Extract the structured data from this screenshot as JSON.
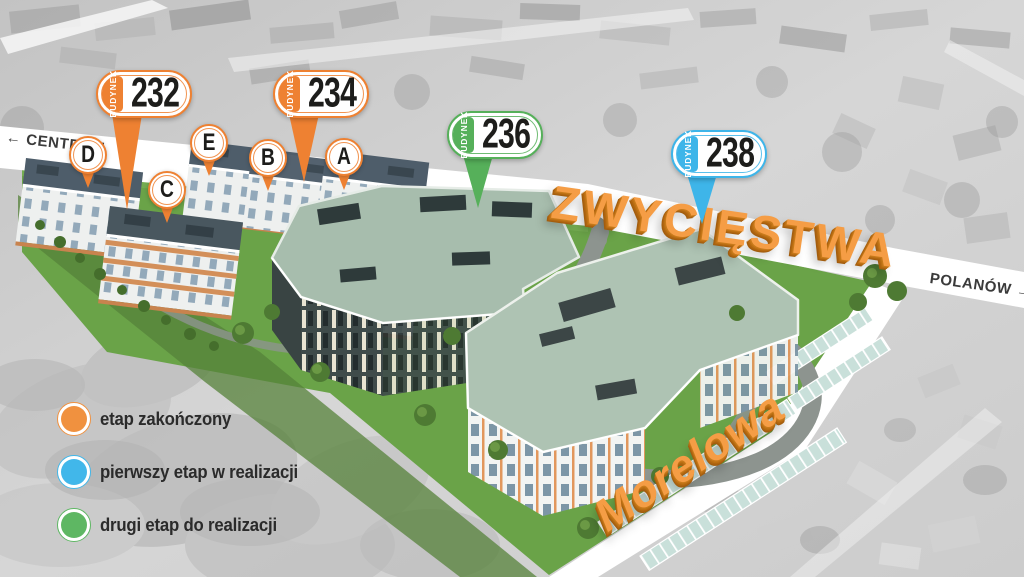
{
  "directions": {
    "centrum_arrow": "←",
    "centrum_label": "CENTRUM",
    "polanow_label": "POLANÓW",
    "polanow_arrow": "→"
  },
  "streets": {
    "main": "ZWYCIĘSTWA",
    "side": "Morelowa"
  },
  "markers": [
    {
      "prefix": "BUDYNEK",
      "number": "232",
      "color": "#ee8132"
    },
    {
      "prefix": "BUDYNEK",
      "number": "234",
      "color": "#ee8132"
    },
    {
      "prefix": "BUDYNEK",
      "number": "236",
      "color": "#56b05a"
    },
    {
      "prefix": "BUDYNEK",
      "number": "238",
      "color": "#3eb5e9"
    }
  ],
  "building_labels": {
    "color": "#ee8132",
    "items": [
      "D",
      "C",
      "E",
      "B",
      "A"
    ]
  },
  "legend": {
    "items": [
      {
        "label": "etap zakończony",
        "color": "#f0913f"
      },
      {
        "label": "pierwszy etap w realizacji",
        "color": "#41b7ea"
      },
      {
        "label": "drugi etap do realizacji",
        "color": "#5eb763"
      }
    ]
  }
}
